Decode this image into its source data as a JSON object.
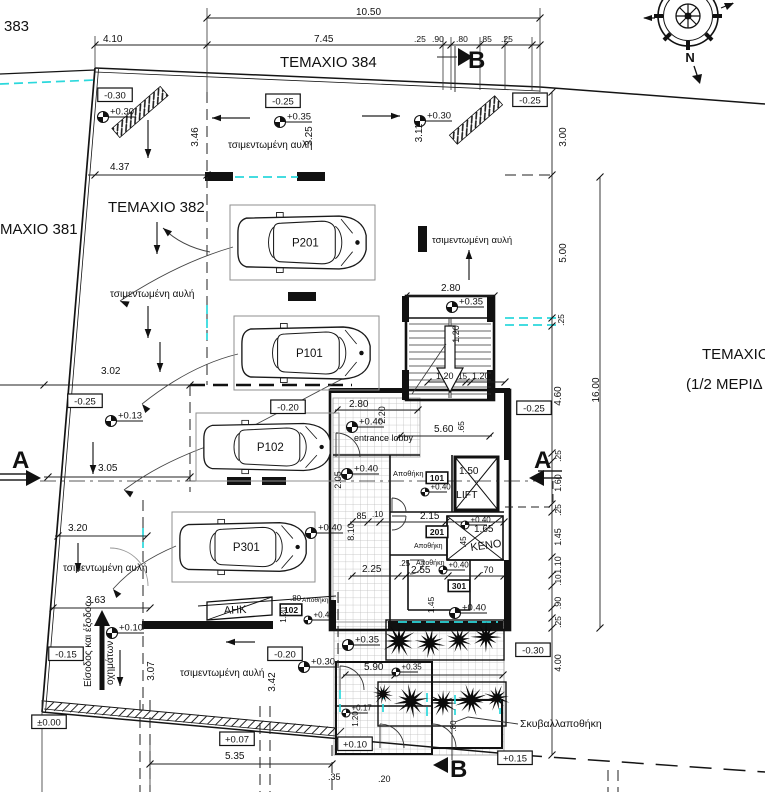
{
  "meta": {
    "drawing_type": "architectural site / ground floor plan",
    "language": "Greek",
    "colors": {
      "line": "#141414",
      "utility_dash": "#2bd8dc",
      "tile_grid": "#bbbbbb"
    }
  },
  "compass": {
    "label": "N"
  },
  "texts": [
    {
      "t": "383",
      "x": 4,
      "y": 31,
      "s": 15,
      "n": "parcel-383"
    },
    {
      "t": "ΤΕΜΑΧΙΟ 384",
      "x": 280,
      "y": 67,
      "s": 15,
      "n": "parcel-384"
    },
    {
      "t": "ΤΕΜΑΧΙΟ 382",
      "x": 108,
      "y": 212,
      "s": 15,
      "n": "parcel-382"
    },
    {
      "t": "ΜΑΧΙΟ 381",
      "x": 0,
      "y": 234,
      "s": 15,
      "n": "parcel-381"
    },
    {
      "t": "ΤΕΜΑΧΙΟ 3",
      "x": 702,
      "y": 359,
      "s": 15,
      "n": "parcel-right"
    },
    {
      "t": "(1/2 ΜΕΡΙΔ",
      "x": 686,
      "y": 389,
      "s": 15,
      "n": "parcel-right-share"
    },
    {
      "t": "τσιμεντωμένη αυλή",
      "x": 228,
      "y": 148,
      "n": "yard-label"
    },
    {
      "t": "τσιμεντωμένη αυλή",
      "x": 110,
      "y": 297,
      "n": "yard-label"
    },
    {
      "t": "τσιμεντωμένη αυλή",
      "x": 432,
      "y": 243,
      "s": 9.5,
      "n": "yard-label"
    },
    {
      "t": "τσιμεντωμένη αυλή",
      "x": 63,
      "y": 571,
      "n": "yard-label"
    },
    {
      "t": "τσιμεντωμένη αυλή",
      "x": 180,
      "y": 676,
      "n": "yard-label"
    },
    {
      "t": "entrance lobby",
      "x": 354,
      "y": 441,
      "s": 9,
      "n": "room-entrance-lobby"
    },
    {
      "t": "Αποθήκη",
      "x": 393,
      "y": 476,
      "s": 7.5,
      "n": "room-storage"
    },
    {
      "t": "Αποθήκη",
      "x": 414,
      "y": 548,
      "s": 7,
      "n": "room-storage"
    },
    {
      "t": "Αποθήκη",
      "x": 416,
      "y": 565,
      "s": 7,
      "n": "room-storage"
    },
    {
      "t": "Αποθήκη",
      "x": 302,
      "y": 602,
      "s": 6.5,
      "n": "room-storage"
    },
    {
      "t": "ΚΕΝΟ",
      "x": 471,
      "y": 551,
      "s": 11,
      "r": -8,
      "n": "room-void"
    },
    {
      "t": "LIFT",
      "x": 456,
      "y": 498,
      "s": 10.5,
      "n": "room-lift"
    },
    {
      "t": "ΑΗΚ",
      "x": 224,
      "y": 614,
      "s": 11,
      "r": -3,
      "n": "room-ahk"
    },
    {
      "t": "Σκυβαλλαποθήκη",
      "x": 520,
      "y": 727,
      "s": 10.5,
      "n": "room-garbage-store"
    },
    {
      "t": "Είσοδος και έξοδος",
      "x": 91,
      "y": 687,
      "s": 10,
      "r": -90,
      "n": "entry-exit-label"
    },
    {
      "t": "οχημάτων",
      "x": 113,
      "y": 685,
      "s": 10,
      "r": -90,
      "n": "entry-exit-label"
    },
    {
      "t": "A",
      "x": 12,
      "y": 468,
      "s": 24,
      "w": 1,
      "n": "section-letter-a"
    },
    {
      "t": "A",
      "x": 534,
      "y": 468,
      "s": 24,
      "w": 1,
      "n": "section-letter-a"
    },
    {
      "t": "B",
      "x": 468,
      "y": 68,
      "s": 24,
      "w": 1,
      "n": "section-letter-b"
    },
    {
      "t": "B",
      "x": 450,
      "y": 777,
      "s": 24,
      "w": 1,
      "n": "section-letter-b"
    },
    {
      "t": "10.50",
      "x": 356,
      "y": 15,
      "n": "dim"
    },
    {
      "t": "4.10",
      "x": 103,
      "y": 42,
      "n": "dim"
    },
    {
      "t": "7.45",
      "x": 314,
      "y": 42,
      "n": "dim"
    },
    {
      "t": ".25",
      "x": 414,
      "y": 42,
      "s": 8.5,
      "n": "dim"
    },
    {
      "t": ".90",
      "x": 432,
      "y": 42,
      "s": 8.5,
      "n": "dim"
    },
    {
      "t": ".80",
      "x": 456,
      "y": 42,
      "s": 8.5,
      "n": "dim"
    },
    {
      "t": ".85",
      "x": 480,
      "y": 42,
      "s": 8.5,
      "n": "dim"
    },
    {
      "t": ".25",
      "x": 501,
      "y": 42,
      "s": 8.5,
      "n": "dim"
    },
    {
      "t": "3.46",
      "x": 198,
      "y": 137,
      "r": -90,
      "a": "m",
      "n": "dim"
    },
    {
      "t": "3.25",
      "x": 312,
      "y": 136,
      "r": -90,
      "a": "m",
      "n": "dim"
    },
    {
      "t": "3.11",
      "x": 422,
      "y": 133,
      "r": -90,
      "a": "m",
      "n": "dim"
    },
    {
      "t": "3.00",
      "x": 566,
      "y": 137,
      "r": -90,
      "a": "m",
      "n": "dim"
    },
    {
      "t": "4.37",
      "x": 110,
      "y": 170,
      "n": "dim"
    },
    {
      "t": "5.00",
      "x": 566,
      "y": 253,
      "r": -90,
      "a": "m",
      "n": "dim"
    },
    {
      "t": "2.80",
      "x": 441,
      "y": 291,
      "n": "dim"
    },
    {
      "t": "1.20",
      "x": 459,
      "y": 334,
      "r": -90,
      "a": "m",
      "s": 9,
      "n": "dim"
    },
    {
      "t": "1.20",
      "x": 436,
      "y": 379,
      "s": 9,
      "n": "dim"
    },
    {
      "t": ".15",
      "x": 456,
      "y": 379,
      "s": 8,
      "n": "dim"
    },
    {
      "t": "1.20",
      "x": 472,
      "y": 379,
      "s": 9,
      "n": "dim"
    },
    {
      "t": "16.00",
      "x": 599,
      "y": 390,
      "r": -90,
      "a": "m",
      "n": "dim"
    },
    {
      "t": "4.60",
      "x": 561,
      "y": 396,
      "r": -90,
      "a": "m",
      "n": "dim"
    },
    {
      "t": ".25",
      "x": 564,
      "y": 320,
      "r": -90,
      "a": "m",
      "s": 8.5,
      "n": "dim"
    },
    {
      "t": ".25",
      "x": 561,
      "y": 456,
      "r": -90,
      "a": "m",
      "s": 8.5,
      "n": "dim"
    },
    {
      "t": "1.60",
      "x": 561,
      "y": 483,
      "r": -90,
      "a": "m",
      "s": 9,
      "n": "dim"
    },
    {
      "t": ".25",
      "x": 561,
      "y": 510,
      "r": -90,
      "a": "m",
      "s": 8.5,
      "n": "dim"
    },
    {
      "t": "1.45",
      "x": 561,
      "y": 537,
      "r": -90,
      "a": "m",
      "s": 9,
      "n": "dim"
    },
    {
      "t": "1.10",
      "x": 561,
      "y": 565,
      "r": -90,
      "a": "m",
      "s": 9,
      "n": "dim"
    },
    {
      "t": ".10",
      "x": 561,
      "y": 580,
      "r": -90,
      "a": "m",
      "s": 8,
      "n": "dim"
    },
    {
      "t": ".90",
      "x": 561,
      "y": 603,
      "r": -90,
      "a": "m",
      "s": 9,
      "n": "dim"
    },
    {
      "t": ".25",
      "x": 561,
      "y": 622,
      "r": -90,
      "a": "m",
      "s": 8.5,
      "n": "dim"
    },
    {
      "t": "4.00",
      "x": 561,
      "y": 663,
      "r": -90,
      "a": "m",
      "s": 9,
      "n": "dim"
    },
    {
      "t": "3.02",
      "x": 101,
      "y": 374,
      "n": "dim"
    },
    {
      "t": "3.05",
      "x": 98,
      "y": 471,
      "n": "dim"
    },
    {
      "t": "3.20",
      "x": 68,
      "y": 531,
      "n": "dim"
    },
    {
      "t": "3.63",
      "x": 86,
      "y": 603,
      "n": "dim"
    },
    {
      "t": "3.07",
      "x": 154,
      "y": 671,
      "r": -90,
      "a": "m",
      "n": "dim"
    },
    {
      "t": "3.42",
      "x": 275,
      "y": 682,
      "r": -90,
      "a": "m",
      "n": "dim"
    },
    {
      "t": "5.35",
      "x": 225,
      "y": 759,
      "n": "dim"
    },
    {
      "t": "5.90",
      "x": 364,
      "y": 670,
      "n": "dim"
    },
    {
      "t": "5.60",
      "x": 434,
      "y": 432,
      "n": "dim"
    },
    {
      "t": ".65",
      "x": 464,
      "y": 427,
      "r": -90,
      "a": "m",
      "s": 8.5,
      "n": "dim"
    },
    {
      "t": "2.80",
      "x": 349,
      "y": 407,
      "n": "dim"
    },
    {
      "t": "2.20",
      "x": 385,
      "y": 415,
      "r": -90,
      "a": "m",
      "s": 9,
      "n": "dim"
    },
    {
      "t": "2.05",
      "x": 341,
      "y": 480,
      "r": -90,
      "a": "m",
      "s": 9,
      "n": "dim"
    },
    {
      "t": "8.10",
      "x": 354,
      "y": 532,
      "r": -90,
      "a": "m",
      "s": 9,
      "n": "dim"
    },
    {
      "t": ".85",
      "x": 354,
      "y": 519,
      "s": 9,
      "n": "dim"
    },
    {
      "t": ".10",
      "x": 372,
      "y": 517,
      "s": 8,
      "n": "dim"
    },
    {
      "t": "2.15",
      "x": 420,
      "y": 519,
      "n": "dim"
    },
    {
      "t": "1.50",
      "x": 459,
      "y": 474,
      "n": "dim"
    },
    {
      "t": "1.65",
      "x": 474,
      "y": 532,
      "n": "dim"
    },
    {
      "t": ".45",
      "x": 466,
      "y": 542,
      "r": -90,
      "a": "m",
      "s": 8,
      "n": "dim"
    },
    {
      "t": "2.25",
      "x": 362,
      "y": 572,
      "n": "dim"
    },
    {
      "t": ".25",
      "x": 399,
      "y": 566,
      "s": 8,
      "n": "dim"
    },
    {
      "t": "2.55",
      "x": 411,
      "y": 573,
      "n": "dim"
    },
    {
      "t": ".70",
      "x": 481,
      "y": 573,
      "s": 9,
      "n": "dim"
    },
    {
      "t": "1.45",
      "x": 434,
      "y": 605,
      "r": -90,
      "a": "m",
      "s": 8.5,
      "n": "dim"
    },
    {
      "t": ".80",
      "x": 290,
      "y": 601,
      "s": 8,
      "n": "dim"
    },
    {
      "t": "1.20",
      "x": 286,
      "y": 615,
      "r": -90,
      "a": "m",
      "s": 8,
      "n": "dim"
    },
    {
      "t": ".80",
      "x": 456,
      "y": 726,
      "r": -90,
      "a": "m",
      "s": 8,
      "n": "dim"
    },
    {
      "t": "1.20",
      "x": 358,
      "y": 719,
      "r": -90,
      "a": "m",
      "s": 8,
      "n": "dim"
    },
    {
      "t": ".35",
      "x": 328,
      "y": 780,
      "s": 9,
      "n": "dim"
    },
    {
      "t": ".20",
      "x": 378,
      "y": 782,
      "s": 9,
      "n": "dim"
    }
  ],
  "spot_levels": [
    {
      "t": "+0.30",
      "x": 103,
      "y": 117
    },
    {
      "t": "+0.35",
      "x": 280,
      "y": 122
    },
    {
      "t": "+0.30",
      "x": 420,
      "y": 121
    },
    {
      "t": "+0.13",
      "x": 111,
      "y": 421
    },
    {
      "t": "+0.35",
      "x": 452,
      "y": 307
    },
    {
      "t": "+0.40",
      "x": 352,
      "y": 427
    },
    {
      "t": "+0.40",
      "x": 347,
      "y": 474
    },
    {
      "t": "+0.40",
      "x": 425,
      "y": 492,
      "sm": 1
    },
    {
      "t": "+0.40",
      "x": 311,
      "y": 533
    },
    {
      "t": "+0.40",
      "x": 465,
      "y": 525,
      "sm": 1
    },
    {
      "t": "+0.40",
      "x": 443,
      "y": 570,
      "sm": 1
    },
    {
      "t": "+0.40",
      "x": 455,
      "y": 613
    },
    {
      "t": "+0.40",
      "x": 308,
      "y": 620,
      "sm": 1
    },
    {
      "t": "+0.10",
      "x": 112,
      "y": 633
    },
    {
      "t": "+0.30",
      "x": 304,
      "y": 667
    },
    {
      "t": "+0.35",
      "x": 348,
      "y": 645
    },
    {
      "t": "+0.35",
      "x": 396,
      "y": 672,
      "sm": 1
    },
    {
      "t": "+0.17",
      "x": 346,
      "y": 713,
      "sm": 1
    }
  ],
  "boxed_levels": [
    {
      "t": "-0.30",
      "x": 115,
      "y": 95
    },
    {
      "t": "-0.25",
      "x": 283,
      "y": 101
    },
    {
      "t": "-0.25",
      "x": 530,
      "y": 100
    },
    {
      "t": "-0.25",
      "x": 85,
      "y": 401
    },
    {
      "t": "-0.20",
      "x": 288,
      "y": 407
    },
    {
      "t": "-0.25",
      "x": 534,
      "y": 408
    },
    {
      "t": "-0.15",
      "x": 66,
      "y": 654
    },
    {
      "t": "-0.20",
      "x": 285,
      "y": 654
    },
    {
      "t": "-0.30",
      "x": 533,
      "y": 650
    },
    {
      "t": "±0.00",
      "x": 49,
      "y": 722
    },
    {
      "t": "+0.07",
      "x": 237,
      "y": 739
    },
    {
      "t": "+0.10",
      "x": 355,
      "y": 744
    },
    {
      "t": "+0.15",
      "x": 515,
      "y": 758
    }
  ],
  "unit_tags": [
    {
      "t": "101",
      "x": 437,
      "y": 478
    },
    {
      "t": "201",
      "x": 437,
      "y": 532
    },
    {
      "t": "301",
      "x": 459,
      "y": 586
    },
    {
      "t": "102",
      "x": 291,
      "y": 610
    }
  ],
  "parking": [
    {
      "t": "P201",
      "x": 230,
      "y": 205,
      "w": 145,
      "h": 75
    },
    {
      "t": "P101",
      "x": 234,
      "y": 316,
      "w": 145,
      "h": 74
    },
    {
      "t": "P102",
      "x": 196,
      "y": 413,
      "w": 143,
      "h": 68
    },
    {
      "t": "P301",
      "x": 172,
      "y": 512,
      "w": 143,
      "h": 70
    }
  ],
  "trees": [
    {
      "x": 399,
      "y": 641,
      "r": 17
    },
    {
      "x": 430,
      "y": 643,
      "r": 15
    },
    {
      "x": 459,
      "y": 640,
      "r": 14
    },
    {
      "x": 486,
      "y": 637,
      "r": 15
    },
    {
      "x": 383,
      "y": 694,
      "r": 11
    },
    {
      "x": 411,
      "y": 701,
      "r": 17
    },
    {
      "x": 443,
      "y": 703,
      "r": 14
    },
    {
      "x": 471,
      "y": 700,
      "r": 16
    },
    {
      "x": 497,
      "y": 698,
      "r": 13
    }
  ]
}
